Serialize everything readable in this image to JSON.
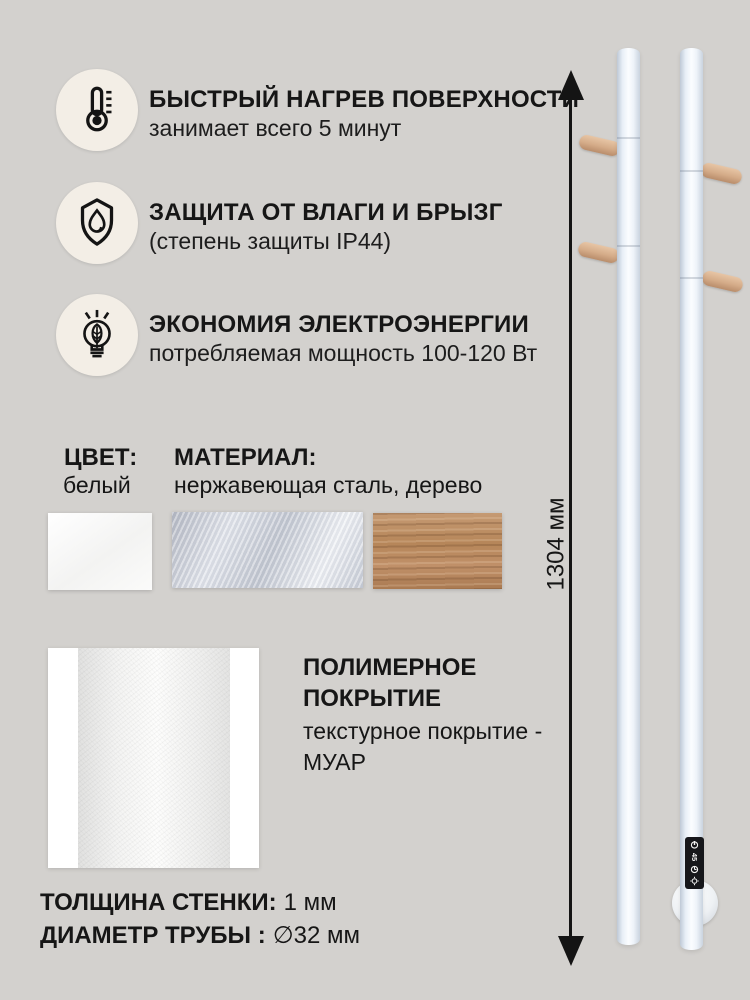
{
  "features": [
    {
      "icon": "thermometer-icon",
      "title": "БЫСТРЫЙ НАГРЕВ ПОВЕРХНОСТИ",
      "subtitle": "занимает всего 5 минут"
    },
    {
      "icon": "shield-drop-icon",
      "title": "ЗАЩИТА ОТ ВЛАГИ И БРЫЗГ",
      "subtitle": "(степень защиты IP44)"
    },
    {
      "icon": "eco-bulb-icon",
      "title": "ЭКОНОМИЯ ЭЛЕКТРОЭНЕРГИИ",
      "subtitle": "потребляемая мощность 100-120 Вт"
    }
  ],
  "color_block": {
    "label": "ЦВЕТ:",
    "value": "белый"
  },
  "material_block": {
    "label": "МАТЕРИАЛ:",
    "value": "нержавеющая сталь, дерево"
  },
  "swatches": [
    "white-texture-swatch",
    "stainless-steel-swatch",
    "wood-swatch"
  ],
  "coating": {
    "title_line1": "ПОЛИМЕРНОЕ",
    "title_line2": "ПОКРЫТИЕ",
    "desc_line1": "текстурное покрытие -",
    "desc_line2": "МУАР"
  },
  "specs": {
    "wall_label": "ТОЛЩИНА СТЕНКИ:",
    "wall_value": "1 мм",
    "diameter_label": "ДИАМЕТР ТРУБЫ :",
    "diameter_value": "∅32 мм"
  },
  "dimension_label": "1304 мм",
  "control_display": {
    "temp": "45",
    "icons": [
      "power-icon",
      "timer-icon",
      "light-icon"
    ]
  },
  "colors": {
    "background": "#d3d1ce",
    "icon_circle": "#f3eee6",
    "text": "#161616",
    "tube_highlight": "#fbfdff",
    "wood": "#b68659",
    "steel": "#c7ccd6",
    "display": "#16171b"
  }
}
